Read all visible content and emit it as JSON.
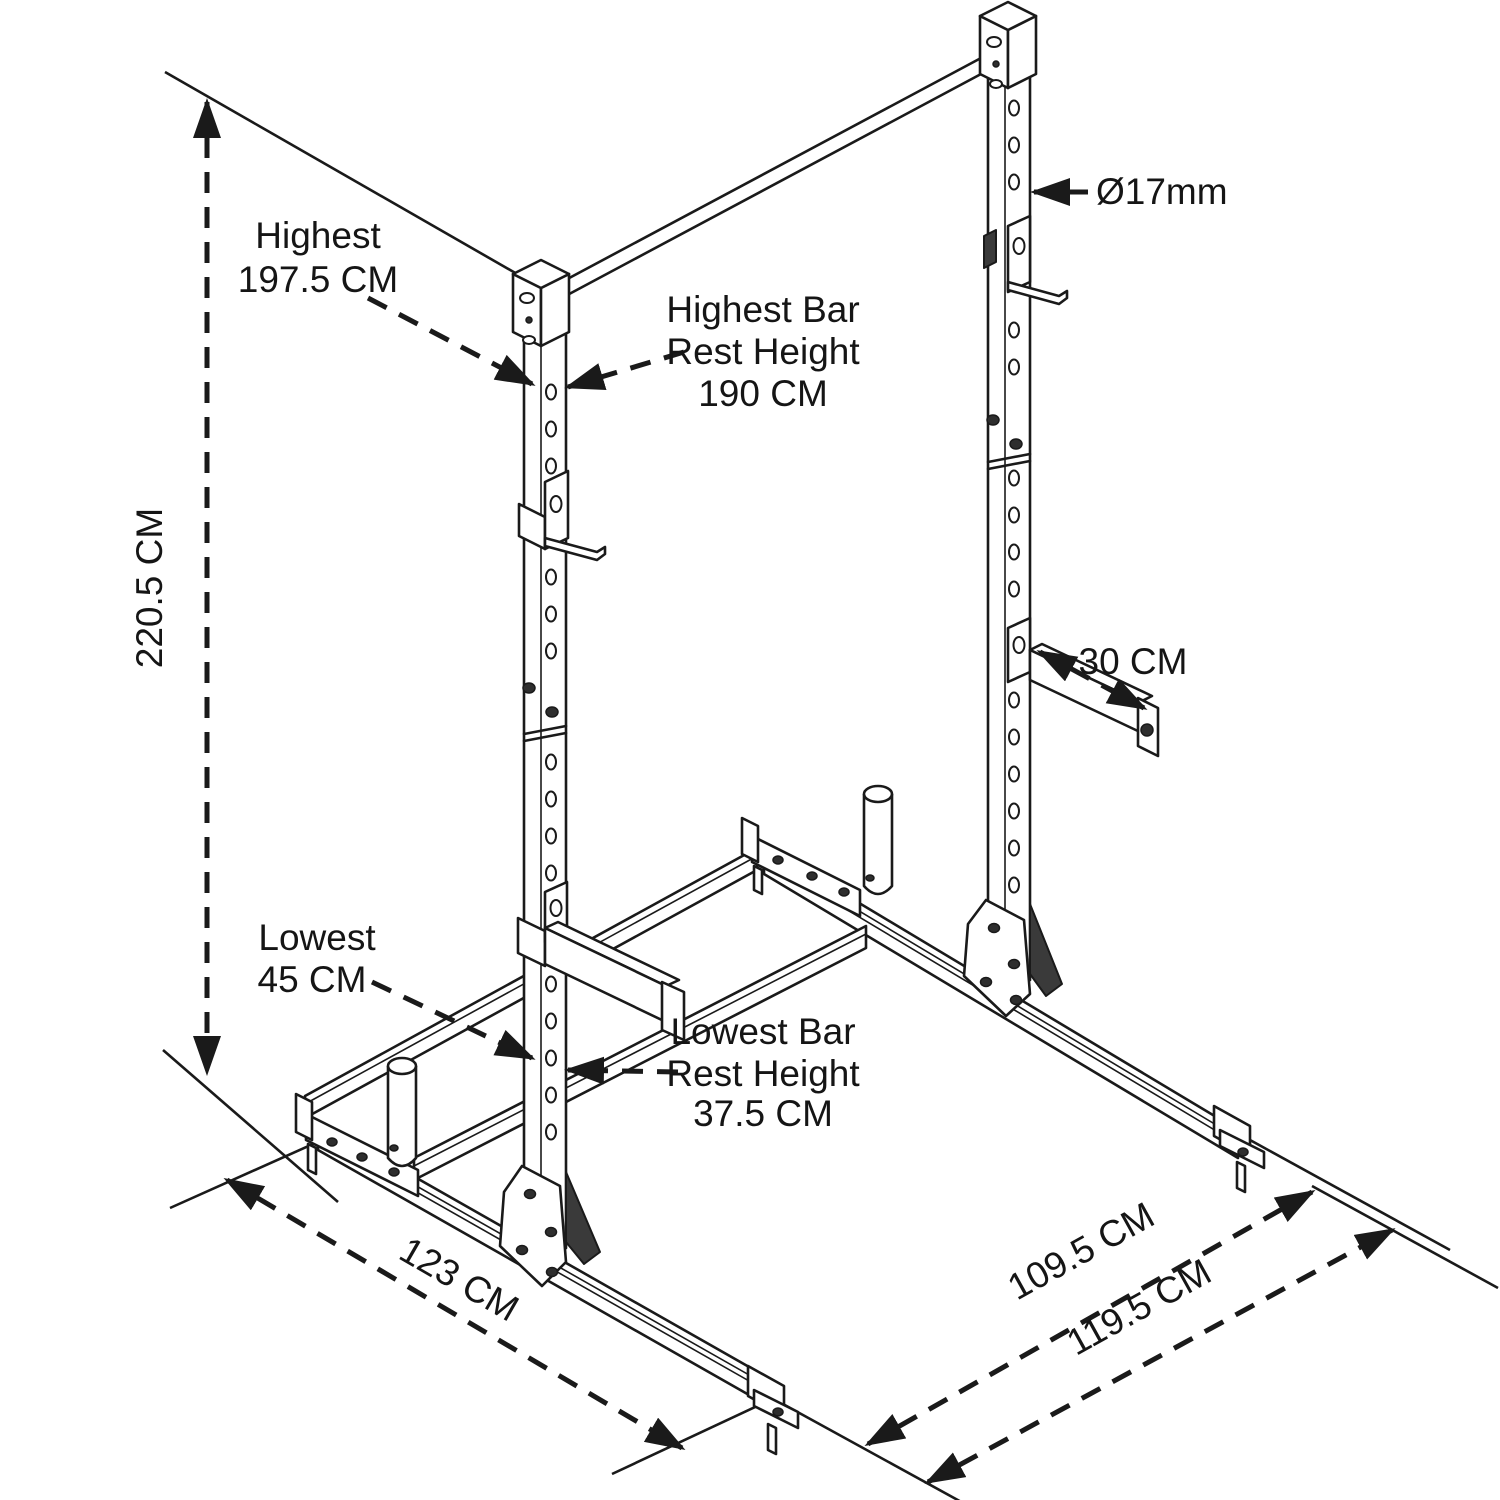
{
  "colors": {
    "ink": "#1a1a1a",
    "background": "#ffffff"
  },
  "annotations": {
    "total_height": {
      "text": "220.5 CM"
    },
    "highest_hook": {
      "line1": "Highest",
      "line2": "197.5 CM"
    },
    "highest_bar_rest": {
      "line1": "Highest Bar",
      "line2": "Rest Height",
      "line3": "190 CM"
    },
    "hole_diameter": {
      "text": "Ø17mm"
    },
    "spotter_arm_length": {
      "text": "30 CM"
    },
    "lowest_hook": {
      "line1": "Lowest",
      "line2": "45 CM"
    },
    "lowest_bar_rest": {
      "line1": "Lowest Bar",
      "line2": "Rest Height",
      "line3": "37.5 CM"
    },
    "base_depth": {
      "text": "123 CM"
    },
    "base_width_inner": {
      "text": "109.5 CM"
    },
    "base_width_outer": {
      "text": "119.5 CM"
    }
  }
}
